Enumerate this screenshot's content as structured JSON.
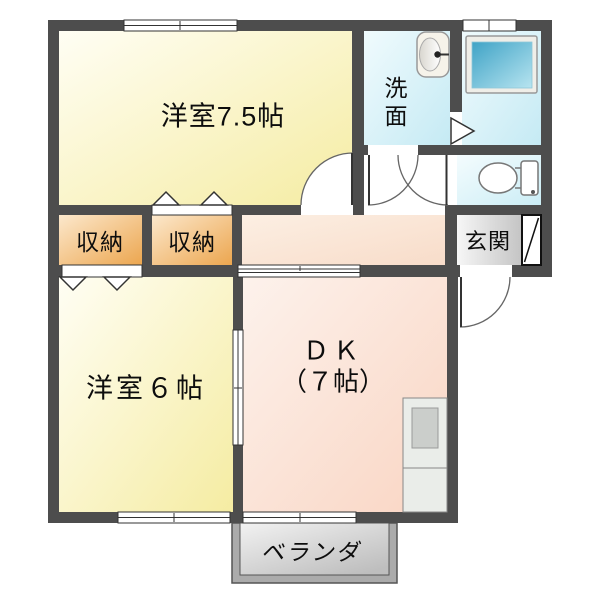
{
  "document": {
    "type": "floor-plan"
  },
  "colors": {
    "wall": "#4d4d4d",
    "room_yellow_light": "#fffef4",
    "room_yellow": "#f5eca2",
    "closet_orange_light": "#fce8cc",
    "closet_orange": "#eca64f",
    "water_cyan_light": "#f0fbfd",
    "water_cyan": "#c5eaf4",
    "dk_peach_light": "#fdf2ec",
    "dk_peach": "#f9d5c3",
    "entrance_gray_light": "#f8f8f8",
    "entrance_gray": "#c4c4c4",
    "veranda_frame": "#ababab",
    "bathtub_blue": "#3fa3c6",
    "bathtub_blue_light": "#b7e4f0",
    "line": "#333333"
  },
  "rooms": {
    "western_room_75": {
      "label": "洋室7.5帖"
    },
    "washroom": {
      "label": "洗面"
    },
    "closet_a": {
      "label": "収納"
    },
    "closet_b": {
      "label": "収納"
    },
    "entrance": {
      "label": "玄関"
    },
    "western_room_6": {
      "label": "洋室６帖"
    },
    "dk": {
      "label": "ＤＫ",
      "size_label": "（７帖）"
    },
    "veranda": {
      "label": "ベランダ"
    }
  },
  "fixtures": {
    "sink": "sink-icon",
    "bathtub": "bathtub-icon",
    "toilet": "toilet-icon",
    "kitchen": "kitchen-counter-icon",
    "front_door": "front-door-icon"
  }
}
